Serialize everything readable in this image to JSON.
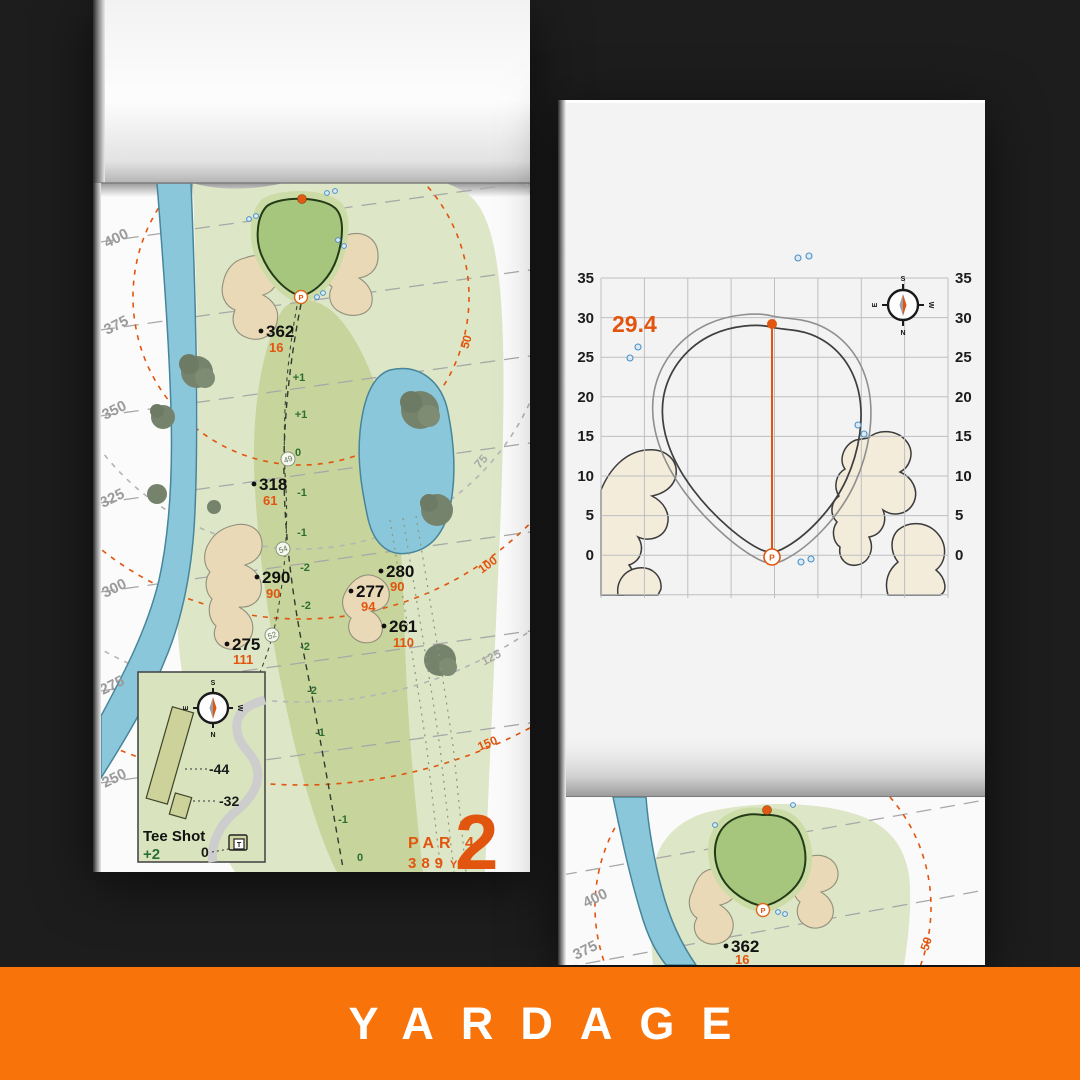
{
  "banner": {
    "label": "YARDAGE",
    "bg_color": "#f8730a"
  },
  "colors": {
    "accent_orange": "#e2550e",
    "banner_orange": "#f8730a",
    "fairway_green": "#c7d49c",
    "rough_green": "#dde6c6",
    "putting_green": "#a6c67d",
    "water_blue": "#8bc7da",
    "sand_beige": "#ead9b6",
    "elevation_green": "#2c6e31",
    "gridline_gray": "#bcbfc2"
  },
  "hole": {
    "number": "2",
    "par": "PAR 4",
    "yardage": "389",
    "unit": "YD",
    "tee_lines": [
      "400",
      "375",
      "350",
      "325",
      "300",
      "275",
      "250"
    ],
    "arc_labels": [
      "50",
      "75",
      "100",
      "125",
      "150"
    ],
    "markers": [
      {
        "d": "362",
        "c": "16"
      },
      {
        "d": "318",
        "c": "61"
      },
      {
        "d": "290",
        "c": "90"
      },
      {
        "d": "280",
        "c": "90"
      },
      {
        "d": "277",
        "c": "94"
      },
      {
        "d": "261",
        "c": "110"
      },
      {
        "d": "275",
        "c": "111"
      }
    ],
    "elevations": [
      "+1",
      "+1",
      "0",
      "-1",
      "-1",
      "-2",
      "-2",
      "-2",
      "-2",
      "-1",
      "-1",
      "0"
    ],
    "waypoints": [
      "49",
      "54",
      "52"
    ],
    "inset": {
      "title": "Tee Shot",
      "score": "+2",
      "origin": "0",
      "offsets": [
        "-44",
        "-32"
      ],
      "tee": "T"
    },
    "pin": "P"
  },
  "green": {
    "front_to_pin": "29.4",
    "axis": [
      "35",
      "30",
      "25",
      "20",
      "15",
      "10",
      "5",
      "0"
    ],
    "pin": "P"
  },
  "next_page": {
    "tee_lines": [
      "400",
      "375"
    ],
    "marker": {
      "d": "362",
      "c": "16"
    },
    "arc_label": "50",
    "pin": "P"
  },
  "compass": {
    "n": "N",
    "s": "S",
    "e": "E",
    "w": "W"
  }
}
